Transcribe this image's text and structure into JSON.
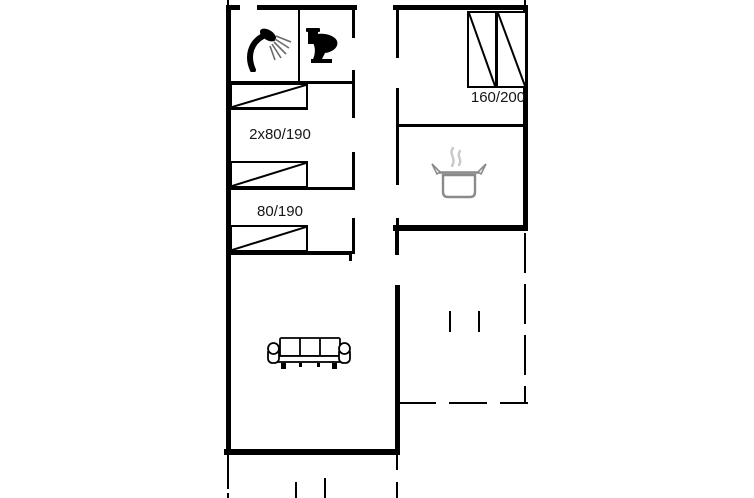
{
  "floorplan": {
    "background_color": "#ffffff",
    "wall_color": "#000000",
    "bed_labels": {
      "bunk_room": "2x80/190",
      "single_room": "80/190",
      "double_room": "160/200"
    },
    "icon_colors": {
      "fixture": "#000000",
      "pot_outline": "#8a8a8a",
      "steam": "#c9c9c9"
    },
    "icons": [
      "shower-icon",
      "toilet-icon",
      "cooking-pot-icon",
      "sofa-icon",
      "single-bed-icon",
      "double-bed-icon"
    ]
  }
}
